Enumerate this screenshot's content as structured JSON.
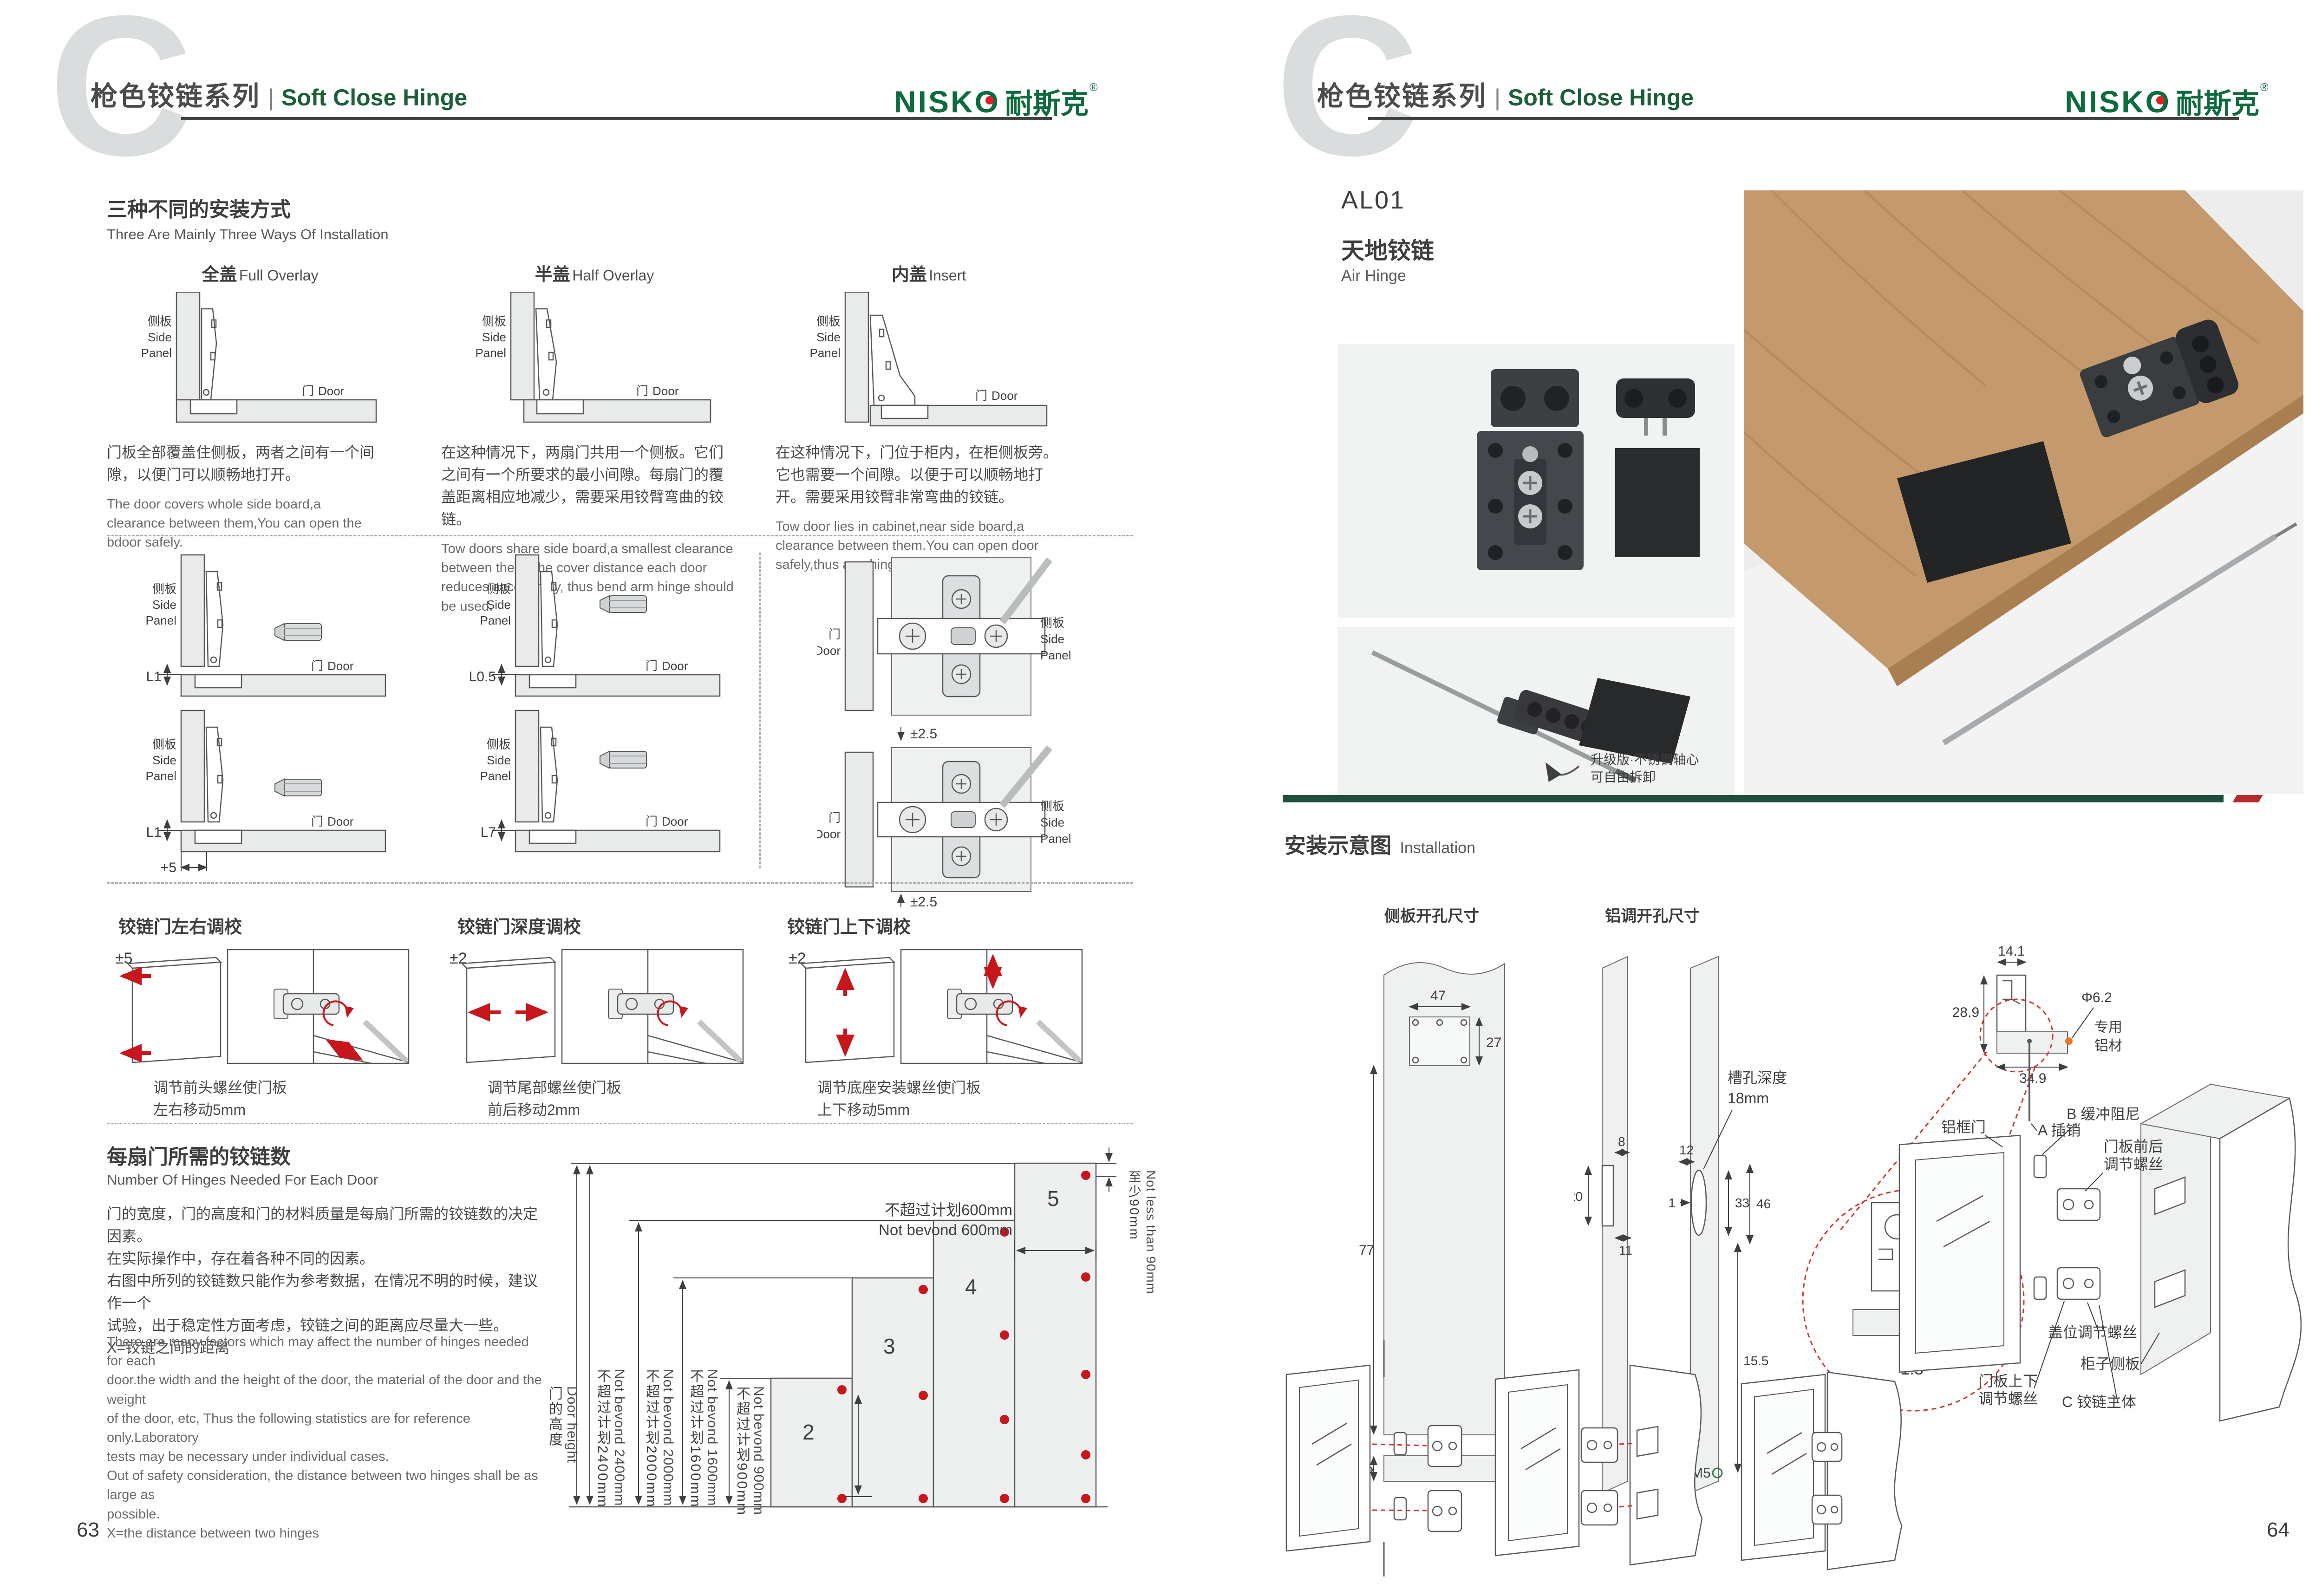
{
  "shared": {
    "watermark": "C",
    "header": {
      "series_cn": "枪色铰链系列",
      "sep": "|",
      "series_en": "Soft Close Hinge"
    },
    "logo": {
      "latin": "NISKO",
      "cn": "耐斯克",
      "reg": "®"
    },
    "labels": {
      "side_cn": "侧板",
      "side_en1": "Side",
      "side_en2": "Panel",
      "door_cn": "门",
      "door_en": "Door"
    },
    "colors": {
      "accent_green": "#1b5e37",
      "logo_green": "#0e6b3e",
      "accent_red": "#c8161d",
      "divider_green": "#1d4f3b",
      "divider_red": "#b8292f"
    }
  },
  "left": {
    "page_number": "63",
    "s1": {
      "title_cn": "三种不同的安装方式",
      "title_en": "Three Are Mainly Three Ways Of Installation",
      "items": [
        {
          "name_cn": "全盖",
          "name_en": "Full Overlay",
          "desc_cn": "门板全部覆盖住侧板，两者之间有一个间隙，以便门可以顺畅地打开。",
          "desc_en": "The door covers whole side board,a clearance between them,You can open the bdoor safely."
        },
        {
          "name_cn": "半盖",
          "name_en": "Half Overlay",
          "desc_cn": "在这种情况下，两扇门共用一个侧板。它们之间有一个所要求的最小间隙。每扇门的覆盖距离相应地减少，需要采用铰臂弯曲的铰链。",
          "desc_en": "Tow doors share side board,a smallest clearance between them,The cover distance each door reduces accordingly, thus bend arm hinge should be used."
        },
        {
          "name_cn": "内盖",
          "name_en": "Insert",
          "desc_cn": "在这种情况下，门位于柜内，在柜侧板旁。它也需要一个间隙。以便于可以顺畅地打开。需要采用铰臂非常弯曲的铰链。",
          "desc_en": "Tow door lies in cabinet,near side board,a clearance between them.You can open door safely,thus arm hinge should be used."
        }
      ]
    },
    "s2": {
      "dims": [
        "L1",
        "L0.5",
        "L1",
        "L7"
      ],
      "plus5": "+5",
      "pm_top": "±2.5",
      "pm_bottom": "±2.5"
    },
    "s3": {
      "items": [
        {
          "title": "铰链门左右调校",
          "pm": "±5",
          "desc1": "调节前头螺丝使门板",
          "desc2": "左右移动5mm"
        },
        {
          "title": "铰链门深度调校",
          "pm": "±2",
          "desc1": "调节尾部螺丝使门板",
          "desc2": "前后移动2mm"
        },
        {
          "title": "铰链门上下调校",
          "pm": "±2",
          "desc1": "调节底座安装螺丝使门板",
          "desc2": "上下移动5mm"
        }
      ]
    },
    "s4": {
      "title_cn": "每扇门所需的铰链数",
      "title_en": "Number Of Hinges Needed For Each Door",
      "desc_cn": [
        "门的宽度，门的高度和门的材料质量是每扇门所需的铰链数的决定因素。",
        "在实际操作中，存在着各种不同的因素。",
        "右图中所列的铰链数只能作为参考数据，在情况不明的时候，建议作一个",
        "试验，出于稳定性方面考虑，铰链之间的距离应尽量大一些。",
        "X=铰链之间的距离"
      ],
      "desc_en": [
        "There are many factors which may affect the number of hinges needed for each",
        "door.the width and the height of the door, the material of the door and the weight",
        "of the door, etc, Thus the following statistics are for reference only.Laboratory",
        "tests may be necessary under individual cases.",
        "Out of safety consideration, the distance between two hinges shall be as large as",
        "possible.",
        "X=the distance between two hinges"
      ]
    },
    "chart_data": {
      "type": "diagram",
      "axis_cn": "门的高度",
      "axis_en": "Door height",
      "hinge_counts": [
        2,
        3,
        4,
        5
      ],
      "heights_mm": [
        900,
        1600,
        2000,
        2400
      ],
      "width_mm": 600,
      "min_edge_mm": 90,
      "doors": [
        {
          "hinges": "2",
          "limit_cn": "不超过计划900mm",
          "limit_en": "Not bevond 900mm"
        },
        {
          "hinges": "3",
          "limit_cn": "不超过计划1600mm",
          "limit_en": "Not bevond 1600mm"
        },
        {
          "hinges": "4",
          "limit_cn": "不超过计划2000mm",
          "limit_en": "Not bevond 2000mm"
        },
        {
          "hinges": "5",
          "limit_cn": "不超过计划2400mm",
          "limit_en": "Not bevond 2400mm"
        }
      ],
      "height_labels": [
        {
          "cn": "不超过计划2400mm",
          "en": "Not bevond 2400mm"
        },
        {
          "cn": "不超过计划2000mm",
          "en": "Not bevond 2000mm"
        },
        {
          "cn": "不超过计划1600mm",
          "en": "Not bevond 1600mm"
        },
        {
          "cn": "不超过计划900mm",
          "en": "Not bevond 900mm"
        }
      ],
      "width_limit_cn": "不超过计划600mm",
      "width_limit_en": "Not bevond 600mm",
      "edge_cn": "至少90mm",
      "edge_en": "Not less than 90mm"
    }
  },
  "right": {
    "page_number": "64",
    "model": "AL01",
    "product_cn": "天地铰链",
    "product_en": "Air Hinge",
    "photo_note1": "升级版·不锈钢轴心",
    "photo_note2": "可自由拆卸",
    "install_cn": "安装示意图",
    "install_en": "Installation",
    "d_side": {
      "title": "侧板开孔尺寸",
      "dim47": "47",
      "dim27": "27",
      "dim77": "77",
      "dim25": "25"
    },
    "d_alu": {
      "title": "铝调开孔尺寸",
      "dim8": "8",
      "dim20": "20",
      "dim11": "11",
      "dim12": "12",
      "dim1": "1",
      "dim33": "33",
      "dim46": "46",
      "dim155": "15.5",
      "m5": "M5",
      "slot1": "槽孔深度",
      "slot2": "18mm"
    },
    "d_profile": {
      "dim141": "14.1",
      "dim289": "28.9",
      "dim349": "34.9",
      "phi": "Φ6.2",
      "alu1": "专用",
      "alu2": "铝材",
      "scale": "1:5",
      "m5": "M5"
    },
    "exploded": {
      "frame_door": "铝框门",
      "a_pin": "A 插销",
      "b_damper": "B 缓冲阻尼",
      "fb1": "门板前后",
      "fb2": "调节螺丝",
      "ud1": "门板上下",
      "ud2": "调节螺丝",
      "cover": "盖位调节螺丝",
      "cabinet_side": "柜子侧板",
      "c_body": "C 铰链主体"
    }
  }
}
